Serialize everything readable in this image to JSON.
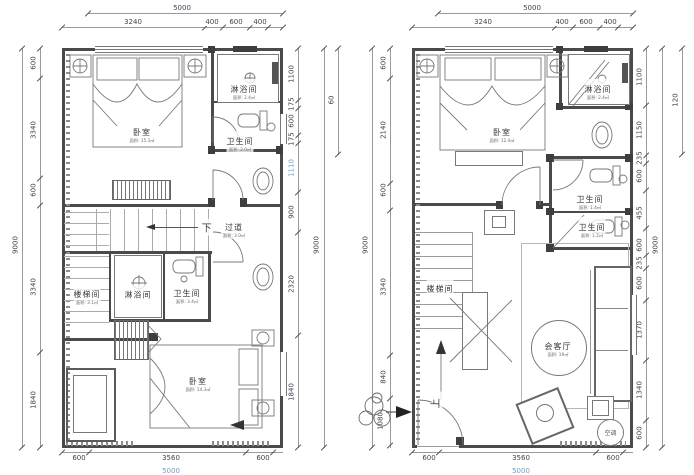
{
  "palette": {
    "wall": "#4a4a4a",
    "line": "#9a9a9a",
    "dim_text": "#3c4650",
    "accent_blue": "#6f9cc6",
    "paper": "#ffffff"
  },
  "plans": [
    {
      "dims": {
        "top_total": "5000",
        "top_segments": [
          "3240",
          "400",
          "600",
          "400"
        ],
        "left_outer": "9000",
        "left_segments": [
          "600",
          "3340",
          "600",
          "3340",
          "1840"
        ],
        "right_segments": [
          "1100",
          "175",
          "600",
          "175",
          "1110",
          "900",
          "2320",
          "1840"
        ],
        "right_outer_top": "60",
        "right_outer": "9000",
        "bottom_segments": [
          "600",
          "3560",
          "600"
        ],
        "bottom_total": "5000"
      },
      "rooms": {
        "bedroom_top": {
          "name": "卧室",
          "area": "面积: 15.3㎡"
        },
        "shower_top": {
          "name": "淋浴间",
          "area": "面积: 2.4㎡"
        },
        "wc_top": {
          "name": "卫生间",
          "area": "面积: 2.0㎡"
        },
        "corridor": {
          "name": "过道",
          "area": "面积: 3.0㎡"
        },
        "stair": {
          "name": "楼梯间",
          "area": "面积: 3.1㎡"
        },
        "shower_mid": {
          "name": "淋浴间",
          "area": ""
        },
        "wc_mid": {
          "name": "卫生间",
          "area": "面积: 3.4㎡"
        },
        "bedroom_bottom": {
          "name": "卧室",
          "area": "面积: 14.3㎡"
        }
      },
      "annotations": {
        "down": "下"
      }
    },
    {
      "dims": {
        "top_total": "5000",
        "top_segments": [
          "3240",
          "400",
          "600",
          "400"
        ],
        "left_outer": "9000",
        "left_segments": [
          "600",
          "2140",
          "600",
          "3340",
          "840",
          "1080"
        ],
        "right_segments": [
          "1100",
          "1150",
          "235",
          "600",
          "455",
          "600",
          "235",
          "600",
          "1370",
          "1340",
          "600"
        ],
        "right_outer_top": "120",
        "right_outer": "9000",
        "bottom_segments": [
          "600",
          "3560",
          "600"
        ],
        "bottom_total": "5000"
      },
      "rooms": {
        "bedroom": {
          "name": "卧室",
          "area": "面积: 12.4㎡"
        },
        "shower": {
          "name": "淋浴间",
          "area": "面积: 2.4㎡"
        },
        "wc1": {
          "name": "卫生间",
          "area": "面积: 1.4㎡"
        },
        "wc2": {
          "name": "卫生间",
          "area": "面积: 1.2㎡"
        },
        "stair": {
          "name": "楼梯间",
          "area": ""
        },
        "living": {
          "name": "会客厅",
          "area": "面积: 19㎡"
        },
        "ac": {
          "name": "空调"
        }
      },
      "annotations": {
        "up": "上"
      }
    }
  ]
}
